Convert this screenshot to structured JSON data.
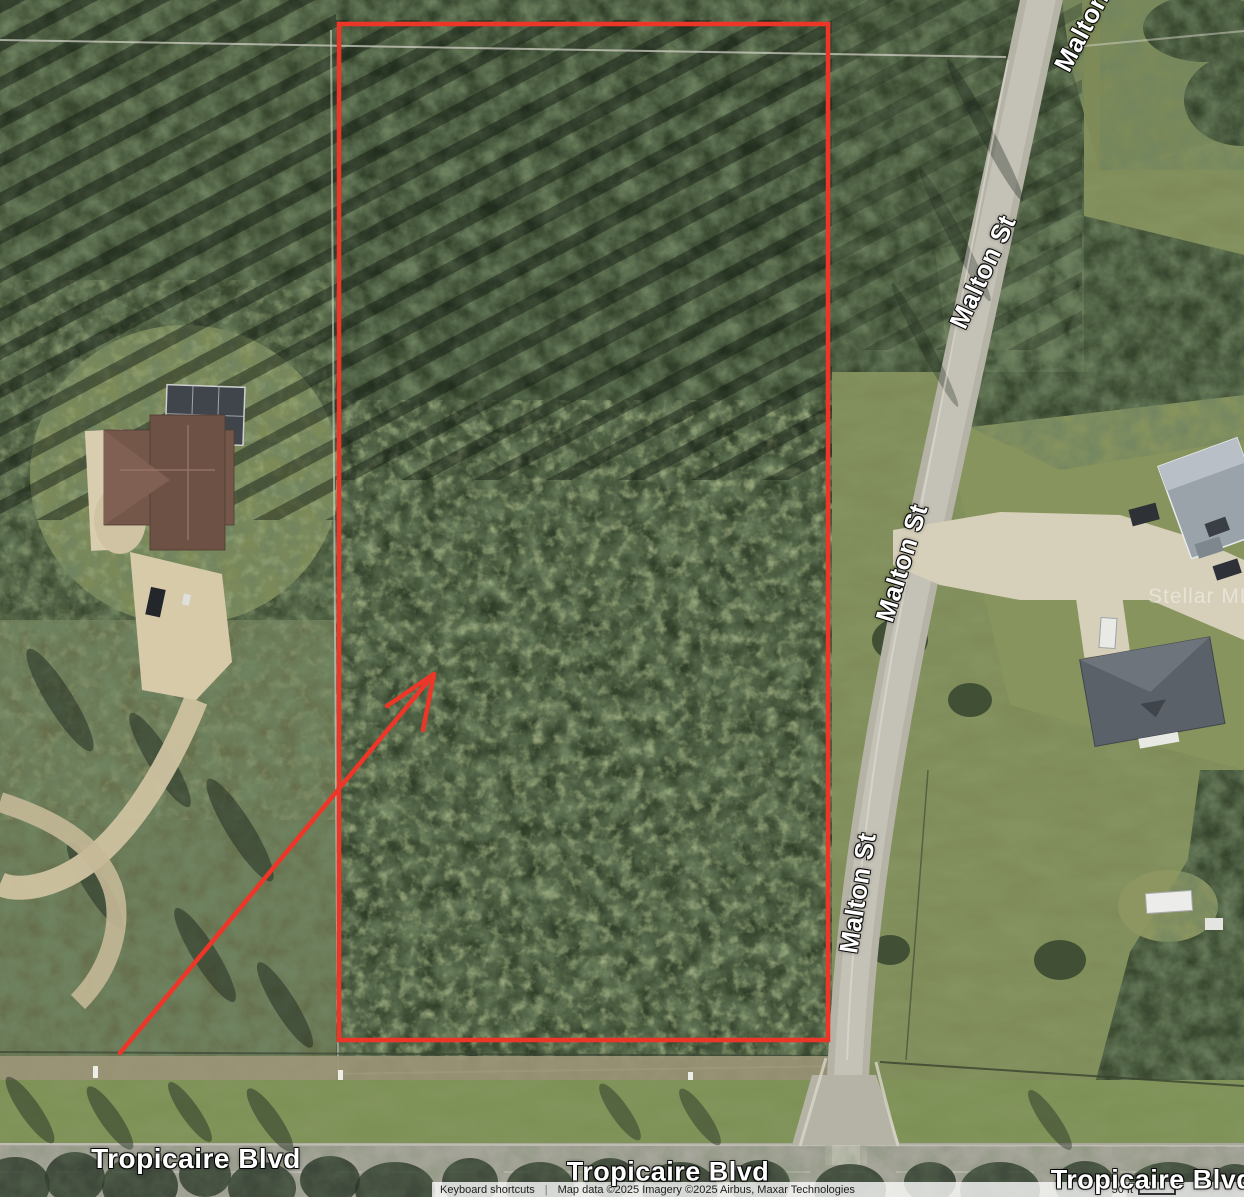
{
  "map_labels": {
    "malton": "Malton St",
    "tropicaire": "Tropicaire Blvd"
  },
  "watermark": "Stellar MLS",
  "annotations": {
    "outline_color": "#ee3628",
    "arrow_color": "#ee3628"
  },
  "attribution": {
    "keyboard_shortcuts": "Keyboard shortcuts",
    "separator": "|",
    "credits": "Map data ©2025  Imagery ©2025 Airbus, Maxar Technologies",
    "scale_label": "50 ft"
  }
}
